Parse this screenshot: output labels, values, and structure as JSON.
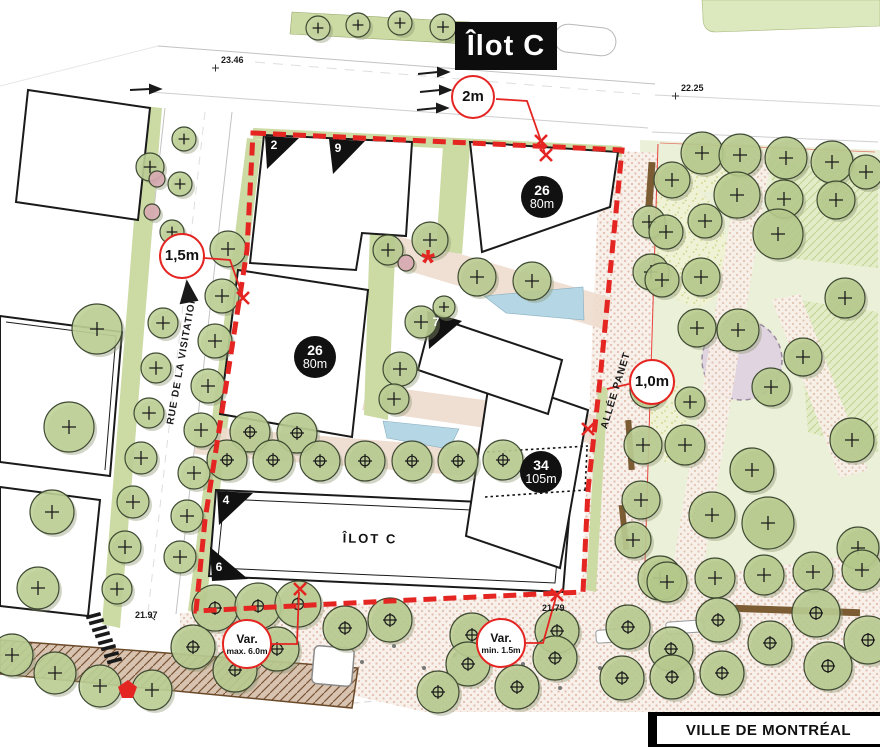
{
  "title": "Îlot C",
  "footer": "VILLE DE MONTRÉAL",
  "block_label": "ÎLOT C",
  "asterisk": "*",
  "streets": {
    "west": "RUE DE LA VISITATION",
    "east": "ALLÉE PANET"
  },
  "callouts": {
    "top": {
      "text": "2m"
    },
    "left": {
      "text": "1,5m"
    },
    "right": {
      "text": "1,0m"
    },
    "var_max": {
      "line1": "Var.",
      "line2": "max. 6.0m"
    },
    "var_min": {
      "line1": "Var.",
      "line2": "min. 1.5m"
    }
  },
  "badges": {
    "b1": {
      "floors": "26",
      "height": "80m"
    },
    "b2": {
      "floors": "26",
      "height": "80m"
    },
    "b3": {
      "floors": "34",
      "height": "105m"
    }
  },
  "corner_numbers": {
    "c2": "2",
    "c9": "9",
    "c7": "7",
    "c4": "4",
    "c6": "6"
  },
  "elevations": {
    "e1": "23.46",
    "e2": "22.25",
    "e3": "21.97",
    "e4": "21.79"
  },
  "colors": {
    "boundary_red": "#e42522",
    "tree_green": "#bdd096",
    "park_lawn": "#ebf0d8",
    "water_blue": "#b5d6e4",
    "path_pink": "#eedbce",
    "badge_black": "#111111",
    "purple_feature": "#ddcfe0",
    "wood_brown": "#7b5c33"
  },
  "trees": {
    "street_plus": [
      [
        150,
        167,
        14
      ],
      [
        184,
        139,
        12
      ],
      [
        180,
        184,
        12
      ],
      [
        172,
        232,
        12
      ],
      [
        228,
        249,
        18
      ],
      [
        222,
        296,
        17
      ],
      [
        215,
        341,
        17
      ],
      [
        208,
        386,
        17
      ],
      [
        201,
        430,
        17
      ],
      [
        194,
        473,
        16
      ],
      [
        187,
        516,
        16
      ],
      [
        180,
        557,
        16
      ],
      [
        163,
        323,
        15
      ],
      [
        156,
        368,
        15
      ],
      [
        149,
        413,
        15
      ],
      [
        141,
        458,
        16
      ],
      [
        133,
        502,
        16
      ],
      [
        125,
        547,
        16
      ],
      [
        117,
        589,
        15
      ],
      [
        97,
        329,
        25
      ],
      [
        69,
        427,
        25
      ],
      [
        52,
        512,
        22
      ],
      [
        38,
        588,
        21
      ],
      [
        12,
        655,
        21
      ],
      [
        55,
        673,
        21
      ],
      [
        100,
        686,
        21
      ],
      [
        152,
        690,
        20
      ]
    ],
    "median_small": [
      [
        318,
        28,
        12
      ],
      [
        358,
        25,
        12
      ],
      [
        400,
        23,
        12
      ],
      [
        443,
        27,
        13
      ]
    ],
    "courtyard_plus": [
      [
        388,
        250,
        15
      ],
      [
        430,
        240,
        18
      ],
      [
        477,
        277,
        19
      ],
      [
        532,
        281,
        19
      ],
      [
        421,
        322,
        16
      ],
      [
        400,
        369,
        17
      ],
      [
        394,
        399,
        15
      ],
      [
        444,
        307,
        11
      ]
    ],
    "courtyard_target": [
      [
        250,
        432,
        20
      ],
      [
        297,
        433,
        20
      ],
      [
        227,
        460,
        20
      ],
      [
        273,
        460,
        20
      ],
      [
        320,
        461,
        20
      ],
      [
        365,
        461,
        20
      ],
      [
        412,
        461,
        20
      ],
      [
        458,
        461,
        20
      ],
      [
        503,
        460,
        20
      ]
    ],
    "allee_plus": [
      [
        649,
        222,
        16
      ],
      [
        651,
        272,
        18
      ],
      [
        648,
        390,
        18
      ],
      [
        643,
        445,
        19
      ],
      [
        641,
        500,
        19
      ],
      [
        633,
        540,
        18
      ]
    ],
    "park_plus": [
      [
        702,
        153,
        21
      ],
      [
        740,
        155,
        21
      ],
      [
        786,
        158,
        21
      ],
      [
        832,
        162,
        21
      ],
      [
        866,
        172,
        17
      ],
      [
        672,
        180,
        18
      ],
      [
        737,
        195,
        23
      ],
      [
        784,
        199,
        19
      ],
      [
        836,
        200,
        19
      ],
      [
        705,
        221,
        17
      ],
      [
        666,
        232,
        17
      ],
      [
        778,
        234,
        25
      ],
      [
        701,
        277,
        19
      ],
      [
        662,
        280,
        17
      ],
      [
        845,
        298,
        20
      ],
      [
        697,
        328,
        19
      ],
      [
        738,
        330,
        21
      ],
      [
        803,
        357,
        19
      ],
      [
        771,
        387,
        19
      ],
      [
        690,
        402,
        15
      ],
      [
        685,
        445,
        20
      ],
      [
        852,
        440,
        22
      ],
      [
        752,
        470,
        22
      ],
      [
        712,
        515,
        23
      ],
      [
        768,
        523,
        26
      ],
      [
        660,
        578,
        22
      ],
      [
        858,
        548,
        21
      ],
      [
        667,
        582,
        20
      ],
      [
        715,
        578,
        20
      ],
      [
        764,
        575,
        20
      ],
      [
        813,
        572,
        20
      ],
      [
        862,
        570,
        20
      ]
    ],
    "plaza_target": [
      [
        215,
        608,
        23
      ],
      [
        258,
        606,
        23
      ],
      [
        298,
        604,
        23
      ],
      [
        193,
        647,
        22
      ],
      [
        235,
        670,
        22
      ],
      [
        277,
        649,
        22
      ],
      [
        345,
        628,
        22
      ],
      [
        390,
        620,
        22
      ],
      [
        472,
        635,
        22
      ],
      [
        468,
        664,
        22
      ],
      [
        517,
        687,
        22
      ],
      [
        557,
        631,
        22
      ],
      [
        555,
        658,
        22
      ],
      [
        438,
        692,
        21
      ],
      [
        628,
        627,
        22
      ],
      [
        718,
        620,
        22
      ],
      [
        671,
        649,
        22
      ],
      [
        622,
        678,
        22
      ],
      [
        672,
        677,
        22
      ],
      [
        722,
        673,
        22
      ],
      [
        816,
        613,
        24
      ],
      [
        828,
        666,
        24
      ],
      [
        868,
        640,
        24
      ],
      [
        770,
        643,
        22
      ]
    ],
    "pink_blossom": [
      [
        157,
        179,
        8
      ],
      [
        152,
        212,
        8
      ],
      [
        406,
        263,
        8
      ]
    ]
  }
}
